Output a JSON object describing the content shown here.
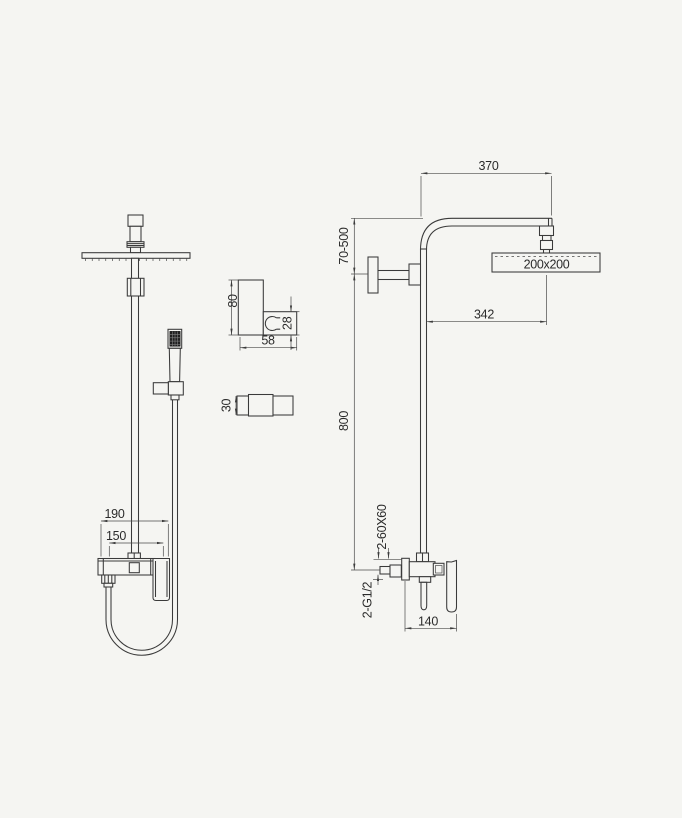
{
  "drawing": {
    "kind": "shower-column-installation-diagram",
    "colors": {
      "background": "#f5f5f2",
      "line": "#3a3a3a",
      "hatch": "#1f1f1f"
    },
    "front_view": {
      "overall_width": "190",
      "connection_spacing": "150"
    },
    "side_view": {
      "arm_length": "370",
      "head_size": "200x200",
      "head_offset": "342",
      "height_range": "70-500",
      "riser_height": "800",
      "escutcheon_spec": "2-60X60",
      "inlet_thread_spec": "2-G1/2",
      "valve_depth": "140"
    },
    "bracket_detail": {
      "height": "80",
      "width": "58",
      "clip_height": "28"
    },
    "bracket_top_detail": {
      "depth": "30"
    }
  }
}
